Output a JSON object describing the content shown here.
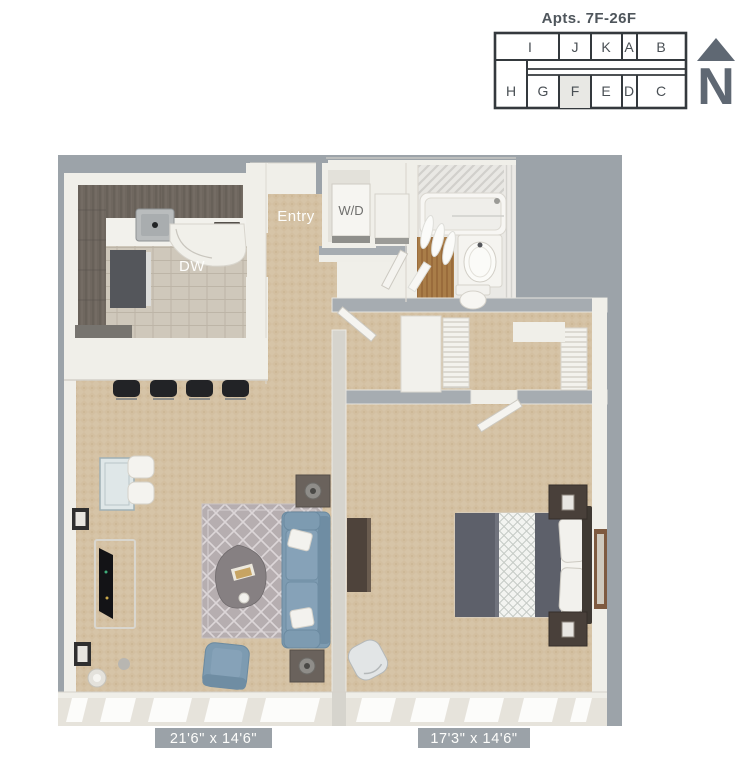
{
  "key_plan": {
    "title": "Apts. 7F-26F",
    "top_row": [
      "I",
      "J",
      "K",
      "A",
      "B"
    ],
    "bottom_row": [
      "H",
      "G",
      "F",
      "E",
      "D",
      "C"
    ],
    "highlighted_unit": "F",
    "north_label": "N"
  },
  "floor_plan": {
    "labels": {
      "entry": "Entry",
      "washer_dryer": "W/D",
      "dishwasher": "DW"
    },
    "dimensions": {
      "living_room": "21'6\" x 14'6\"",
      "bedroom": "17'3\" x 14'6\""
    },
    "colors": {
      "plan_background_gray": "#9ca3a9",
      "wall_white": "#f0efe9",
      "carpet_tan": "#d6c4a7",
      "kitchen_tile": "#cfc8bb",
      "cabinet_brown": "#6f675f",
      "sofa_blue": "#7d9bb1",
      "keyplan_line": "#34393d",
      "north_arrow": "#5f6873"
    }
  }
}
